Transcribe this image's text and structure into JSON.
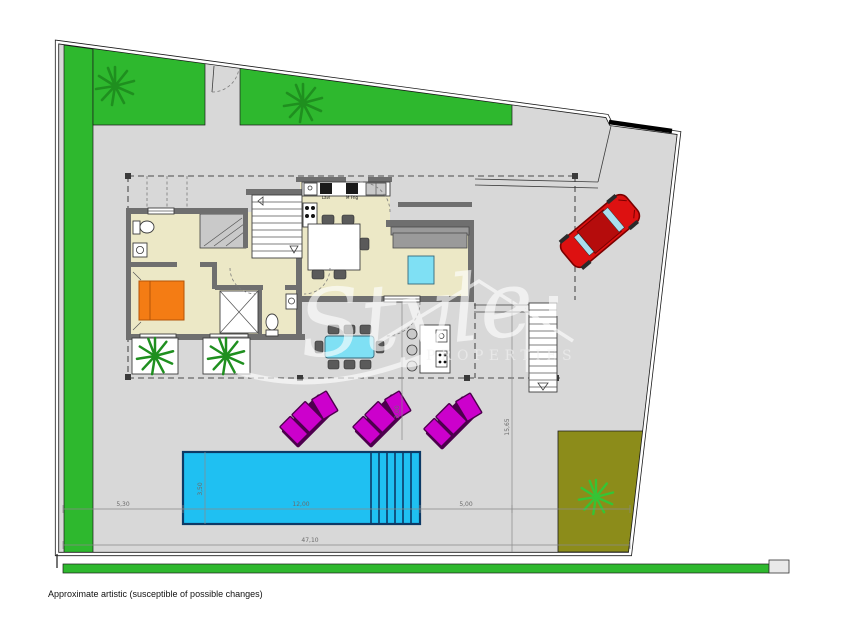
{
  "meta": {
    "caption": "Approximate artistic (susceptible of possible changes)"
  },
  "watermark": {
    "script": "Style",
    "caps": "PROPERTIES"
  },
  "dimensions": {
    "bottom_total": "47,10",
    "left_gap": "5,30",
    "pool_length": "12,00",
    "right_gap": "5,00",
    "terrace_depth": "3,00",
    "right_side_height": "15,65",
    "pool_width": "3,50"
  },
  "kitchen": {
    "label_dishwasher": "Lavl",
    "label_fridge": "M Frig"
  },
  "colors": {
    "paving": "#d8d8d8",
    "line": "#1a1a1a",
    "grass": "#2eb82e",
    "grassDark": "#1f8f1f",
    "olive": "#8c8c1a",
    "floor": "#ece8c6",
    "wall": "#6f6f6f",
    "pool": "#1fc0f2",
    "poolEdge": "#0d3a66",
    "cyan": "#7fe0f4",
    "lounger": "#cc00cc",
    "loungerShadow": "#4d004d",
    "bedOrange": "#f47c14",
    "carRed": "#dd1111",
    "carDark": "#7a0000",
    "carWindow": "#aadeee",
    "dim": "#8a8a8a"
  }
}
